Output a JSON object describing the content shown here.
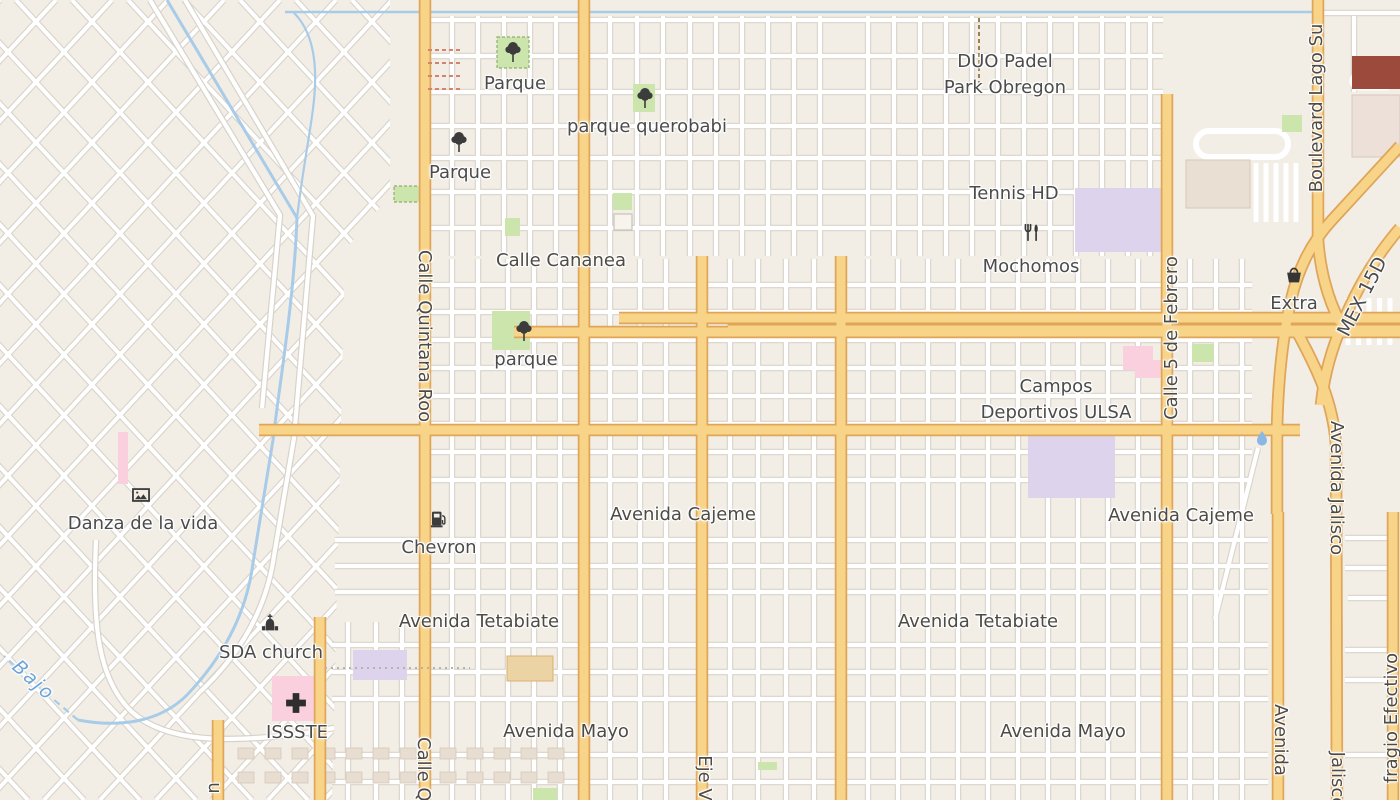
{
  "app": {
    "type": "map-viewer",
    "region": "street map"
  },
  "colors": {
    "land": "#f2eee6",
    "road_major_fill": "#f8d489",
    "road_major_casing": "#dfa558",
    "road_minor_fill": "#ffffff",
    "road_minor_casing": "#d8d3ca",
    "water": "#a8cbe8",
    "park_green": "#cbe5ad",
    "school_purple": "#ded3ec",
    "hospital_pink": "#fbd0de",
    "building": "#e7ddd0",
    "label_text": "#4b4b4b"
  },
  "streets": {
    "cananea": "Calle Cananea",
    "cajeme": "Avenida Cajeme",
    "tetabiate": "Avenida Tetabiate",
    "mayo": "Avenida Mayo",
    "quintana_roo": "Calle Quintana Roo",
    "quintana_roo_fragment": "Calle Qu",
    "cinco_de_febrero": "Calle 5 de Febrero",
    "boulevard_lago": "Boulevard Lago Su",
    "mex_15d": "MEX 15D",
    "avenida_jalisco": "Avenida Jalisco",
    "jalisco_fragment": "Jalisco",
    "avenida_fragment": "Avenida",
    "eje_fragment": "Eje V",
    "sufragio_fragment": "fragio Efectivo",
    "letter_fragment": "u"
  },
  "pois": {
    "parque_nw": "Parque",
    "parque_w": "Parque",
    "parque_querobabi": "parque querobabi",
    "parque_s": "parque",
    "duo_padel_line1": "DUO Padel",
    "duo_padel_line2": "Park Obregon",
    "tennis": "Tennis HD",
    "mochomos": "Mochomos",
    "extra": "Extra",
    "campos_line1": "Campos",
    "campos_line2": "Deportivos ULSA",
    "danza": "Danza de la vida",
    "chevron": "Chevron",
    "sda_church": "SDA church",
    "issste": "ISSSTE"
  },
  "water": {
    "bajo": "Bajo"
  },
  "icons": [
    "tree-icon",
    "restaurant-icon",
    "shopping-basket-icon",
    "fuel-icon",
    "church-icon",
    "artwork-icon",
    "hospital-cross-icon",
    "water-droplet-icon"
  ]
}
